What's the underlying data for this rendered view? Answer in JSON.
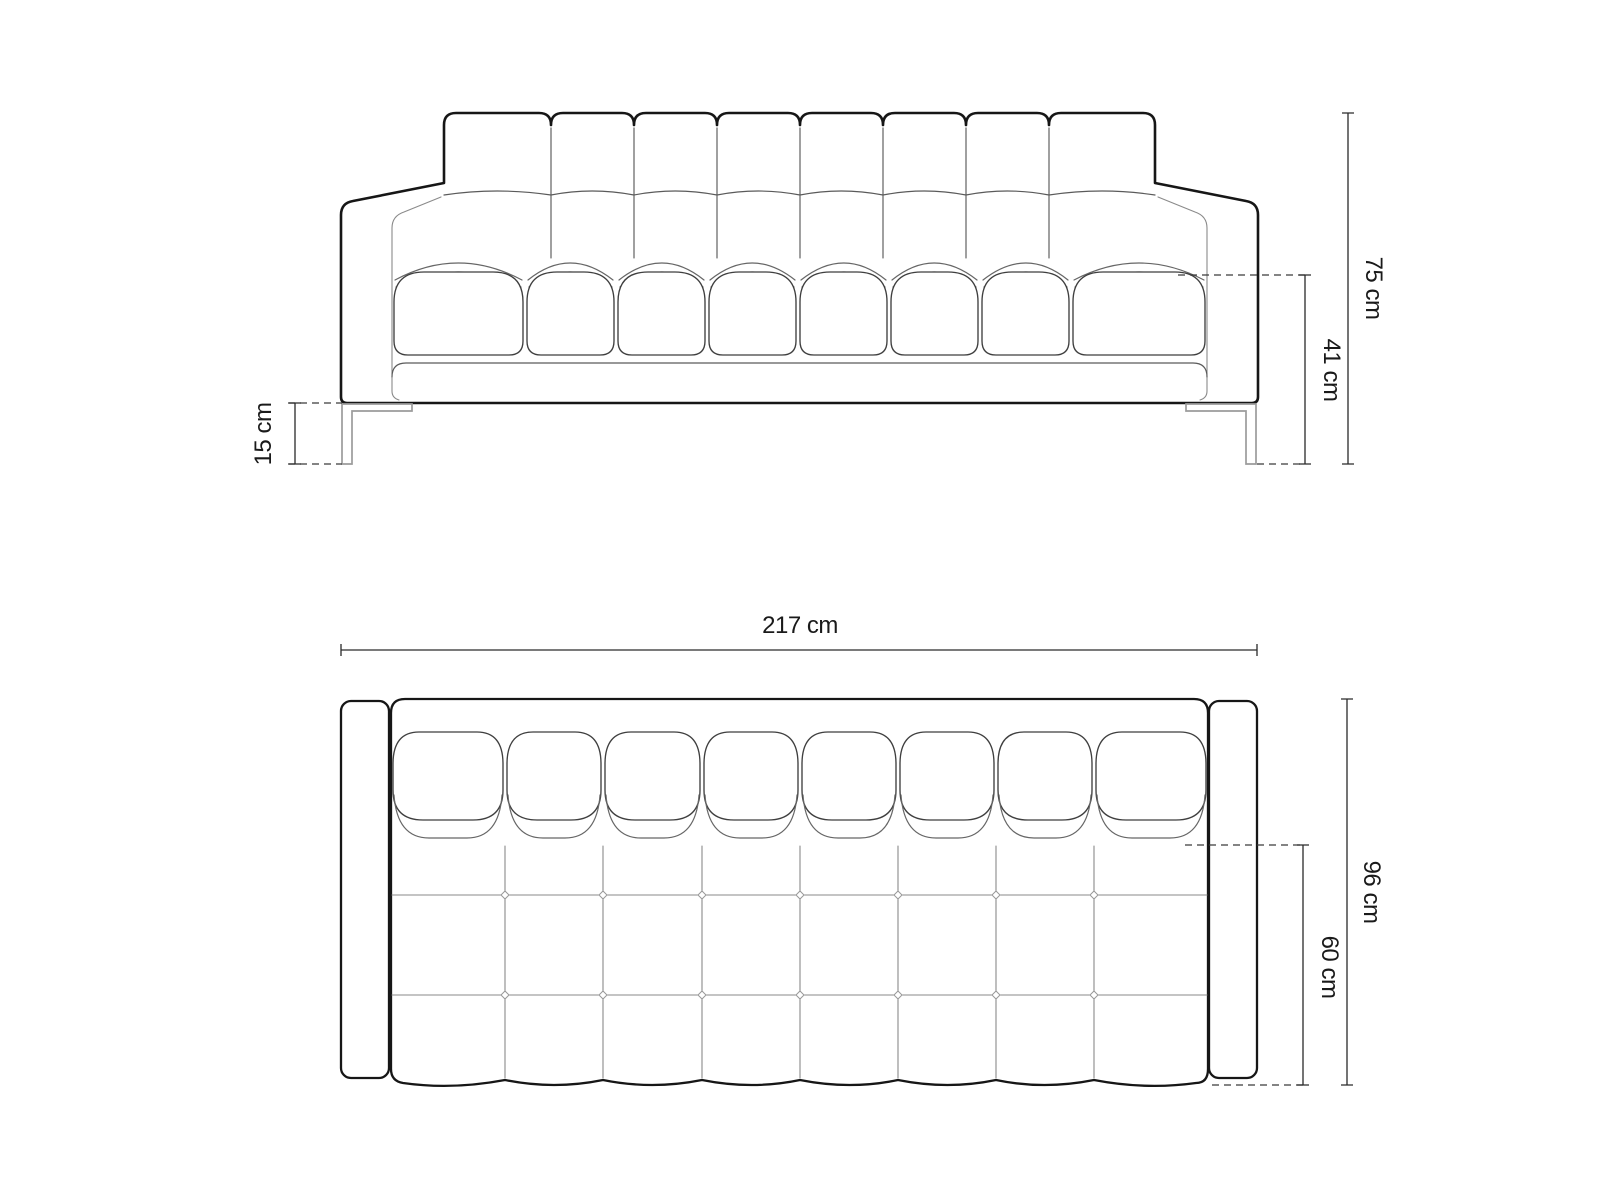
{
  "diagram": {
    "kind": "furniture-dimension-drawing",
    "subject": "tufted sofa, front elevation and top plan",
    "background": "#ffffff"
  },
  "labels": {
    "front_height": "75 cm",
    "front_seat_height": "41 cm",
    "front_leg_height": "15 cm",
    "top_width": "217 cm",
    "top_depth": "96 cm",
    "top_seat_depth": "60 cm"
  },
  "views": {
    "front": {
      "back_cushion_columns": 8,
      "seat_cushions": 8,
      "legs": 2
    },
    "top": {
      "back_cushions": 8,
      "seat_grid_columns": 8,
      "seat_grid_rows": 3
    }
  },
  "colors": {
    "outline": "#161616",
    "cushion_line": "#3f3f3f",
    "seam_line": "#8a8a8a",
    "leg_line": "#9b9b9b",
    "dimension_line": "#2a2a2a",
    "text": "#1a1a1a",
    "background": "#ffffff"
  }
}
